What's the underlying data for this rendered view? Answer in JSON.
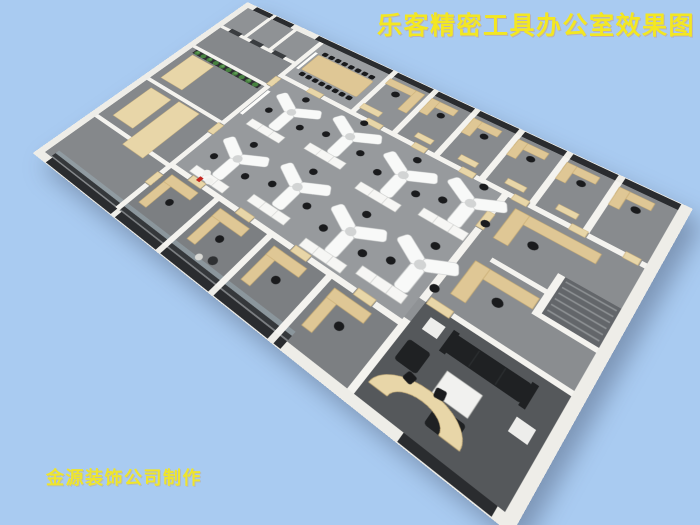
{
  "title": "乐客精密工具办公室效果图",
  "watermark": "金源装饰公司制作",
  "colors": {
    "bg": "#a9cbf1",
    "title-text": "#f3e722",
    "watermark-text": "#efe52c",
    "wall": "#f4f3ef",
    "facade": "#eeede8",
    "floor": "#8f9295",
    "floor-light": "#979a9d",
    "floor-dark": "#7c7f82",
    "lounge-floor": "#55585b",
    "window": "#2a2c2f",
    "wood": "#dfc795",
    "wood-light": "#e8d6a8",
    "chair": "#1a1b1d",
    "plant": "#46813f",
    "white-furniture": "#f6f6f4",
    "glass": "#9db4bc"
  },
  "scene": {
    "view": "aerial cutaway office render",
    "conference_chairs": 16,
    "desk_clusters": 8,
    "seats_per_cluster": 3,
    "perimeter_offices_top": 5,
    "perimeter_offices_bottom": 4
  }
}
